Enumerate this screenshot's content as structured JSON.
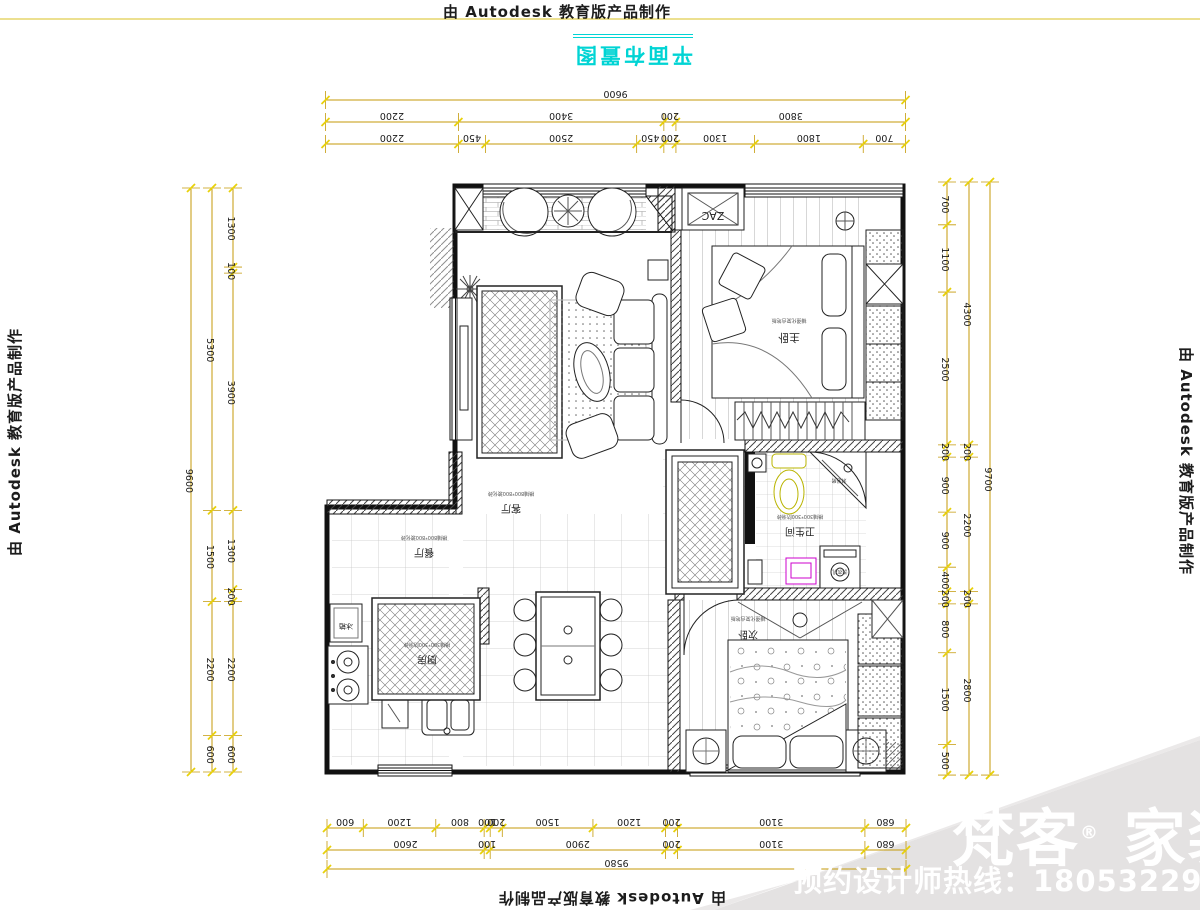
{
  "watermarks": {
    "top": "由 Autodesk 教育版产品制作",
    "bottom": "由 Autodesk 教育版产品制作",
    "left": "由 Autodesk 教育版产品制作",
    "right": "由 Autodesk 教育版产品制作"
  },
  "title": {
    "text": "平面布置图",
    "color": "#00d4d4"
  },
  "branding": {
    "logo_part1": "梵客",
    "registered": "®",
    "logo_part2": "家装",
    "hotline": "预约设计师热线：18053229526",
    "band_color": "#e4e2e2",
    "band_color2": "#ebe9e9",
    "text_color": "#ffffff"
  },
  "dimension_color": {
    "line": "#c49a08",
    "tick": "#e8d10a",
    "text": "#1a1a1a"
  },
  "dim_chains": [
    {
      "name": "dim-top-overall",
      "dir": "h",
      "x0": 325.5,
      "y": 100,
      "scale": 0.06042,
      "values": [
        9600
      ]
    },
    {
      "name": "dim-top-mid",
      "dir": "h",
      "x0": 325.5,
      "y": 122,
      "scale": 0.06042,
      "values": [
        2200,
        3400,
        200,
        3800
      ]
    },
    {
      "name": "dim-top-inner",
      "dir": "h",
      "x0": 325.5,
      "y": 144,
      "scale": 0.06042,
      "values": [
        2200,
        450,
        2500,
        450,
        200,
        1300,
        1800,
        700
      ]
    },
    {
      "name": "dim-bottom-inner",
      "dir": "h",
      "x0": 327,
      "y": 828,
      "scale": 0.06044,
      "values": [
        600,
        1200,
        800,
        100,
        200,
        1500,
        1200,
        200,
        3100,
        680
      ]
    },
    {
      "name": "dim-bottom-mid",
      "dir": "h",
      "x0": 327,
      "y": 850,
      "scale": 0.06044,
      "values": [
        2600,
        100,
        2900,
        200,
        3100,
        680
      ]
    },
    {
      "name": "dim-bottom-overall",
      "dir": "h",
      "x0": 327,
      "y": 869,
      "scale": 0.06044,
      "values": [
        9580
      ]
    },
    {
      "name": "dim-left-inner",
      "dir": "v",
      "x": 233,
      "y0": 188,
      "scale": 0.06083,
      "values": [
        1300,
        100,
        3900,
        1300,
        200,
        2200,
        600
      ]
    },
    {
      "name": "dim-left-mid",
      "dir": "v",
      "x": 212,
      "y0": 188,
      "scale": 0.06083,
      "values": [
        5300,
        1500,
        2200,
        600
      ]
    },
    {
      "name": "dim-left-overall",
      "dir": "v",
      "x": 191,
      "y0": 188,
      "scale": 0.06083,
      "values": [
        9600
      ]
    },
    {
      "name": "dim-right-inner",
      "dir": "v",
      "x": 947,
      "y0": 182,
      "scale": 0.06114,
      "values": [
        700,
        1100,
        2500,
        200,
        900,
        900,
        400,
        200,
        800,
        1500,
        500
      ]
    },
    {
      "name": "dim-right-mid",
      "dir": "v",
      "x": 969,
      "y0": 182,
      "scale": 0.06114,
      "values": [
        4300,
        200,
        2200,
        200,
        2800
      ]
    },
    {
      "name": "dim-right-overall",
      "dir": "v",
      "x": 990,
      "y0": 182,
      "scale": 0.06114,
      "values": [
        9700
      ]
    }
  ],
  "plan_labels": [
    {
      "name": "room-label-living",
      "text": "客厅",
      "x": 511,
      "y": 505,
      "size": 10,
      "rot": 180,
      "color": "#222"
    },
    {
      "name": "room-note-living",
      "text": "横铺800*800玻化砖",
      "x": 511,
      "y": 492,
      "size": 5,
      "rot": 180,
      "color": "#555"
    },
    {
      "name": "room-label-dining",
      "text": "餐厅",
      "x": 424,
      "y": 549,
      "size": 10,
      "rot": 180,
      "color": "#222"
    },
    {
      "name": "room-note-dining",
      "text": "横铺800*800玻化砖",
      "x": 424,
      "y": 536,
      "size": 5,
      "rot": 180,
      "color": "#555"
    },
    {
      "name": "room-label-kitchen",
      "text": "厨房",
      "x": 427,
      "y": 656,
      "size": 10,
      "rot": 180,
      "color": "#222"
    },
    {
      "name": "room-note-kitchen",
      "text": "横铺300*300防滑砖",
      "x": 427,
      "y": 643,
      "size": 5,
      "rot": 180,
      "color": "#555"
    },
    {
      "name": "room-label-master-bedroom",
      "text": "主卧",
      "x": 789,
      "y": 334,
      "size": 11,
      "rot": 180,
      "color": "#222"
    },
    {
      "name": "room-note-master-bedroom",
      "text": "铺强化复合地板",
      "x": 789,
      "y": 319,
      "size": 5,
      "rot": 180,
      "color": "#555"
    },
    {
      "name": "room-label-bathroom",
      "text": "卫生间",
      "x": 800,
      "y": 528,
      "size": 10,
      "rot": 180,
      "color": "#222"
    },
    {
      "name": "room-note-bathroom",
      "text": "横铺300*300防滑砖",
      "x": 800,
      "y": 515,
      "size": 5,
      "rot": 180,
      "color": "#555"
    },
    {
      "name": "room-label-bedroom2",
      "text": "次卧",
      "x": 748,
      "y": 631,
      "size": 10,
      "rot": 180,
      "color": "#222"
    },
    {
      "name": "room-note-bedroom2",
      "text": "铺强化复合地板",
      "x": 748,
      "y": 617,
      "size": 5,
      "rot": 180,
      "color": "#555"
    },
    {
      "name": "ac-unit-label",
      "text": "ZAC",
      "x": 713,
      "y": 212,
      "size": 11,
      "rot": 180,
      "color": "#222"
    },
    {
      "name": "fridge-label",
      "text": "冰箱",
      "x": 346,
      "y": 624,
      "size": 7,
      "rot": 180,
      "color": "#222"
    },
    {
      "name": "washing-machine-label",
      "text": "洗衣机",
      "x": 840,
      "y": 570,
      "size": 5,
      "rot": 180,
      "color": "#333"
    },
    {
      "name": "shower-label",
      "text": "淋浴房",
      "x": 839,
      "y": 479,
      "size": 5,
      "rot": 180,
      "color": "#333"
    }
  ]
}
